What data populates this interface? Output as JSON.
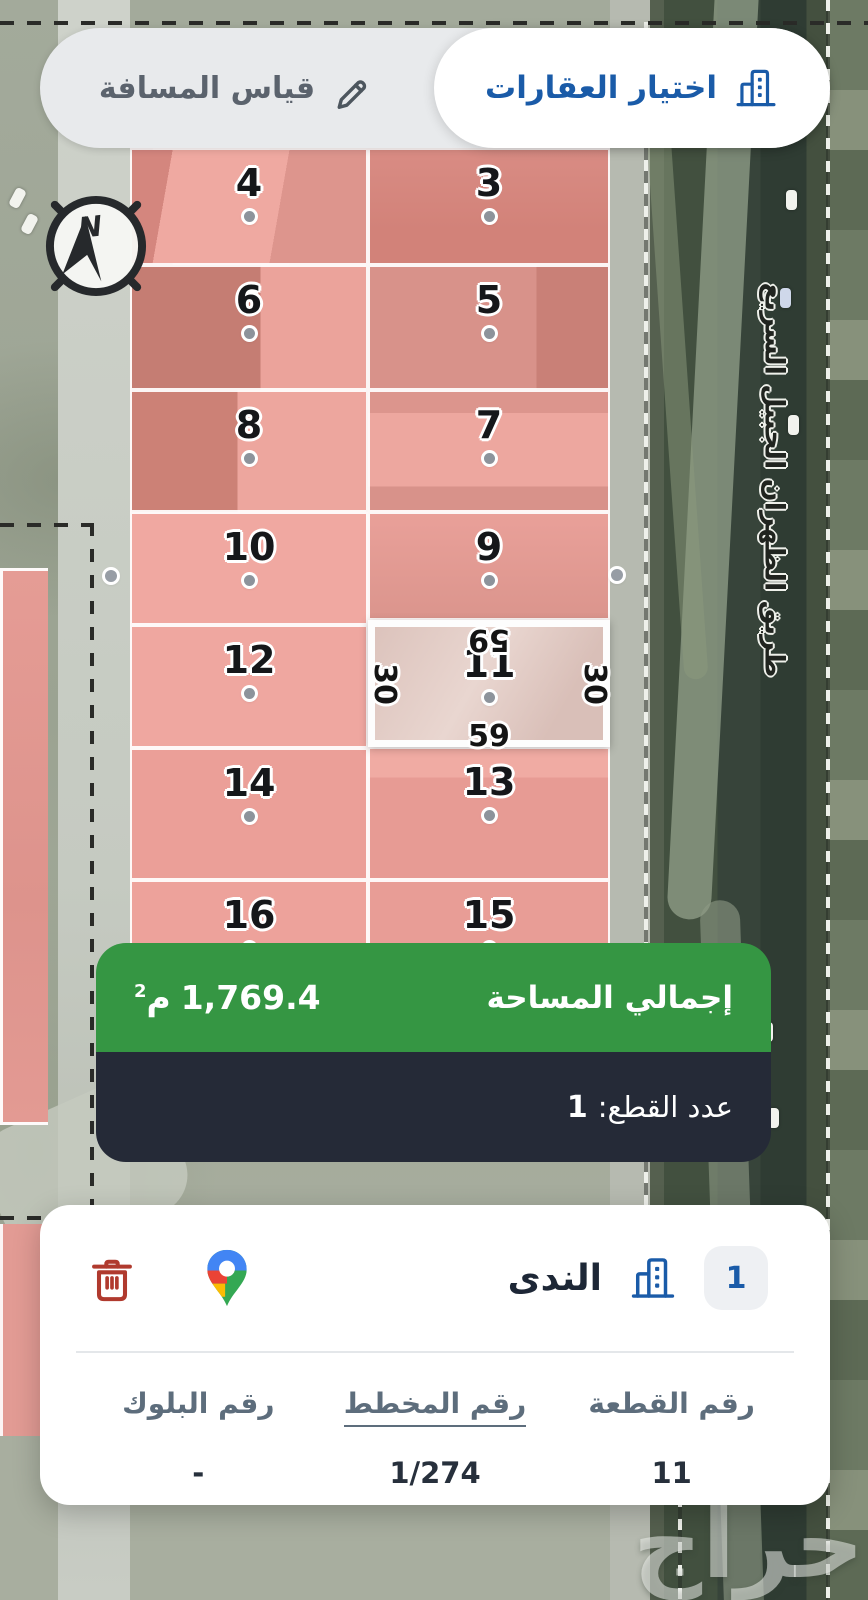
{
  "toolbar": {
    "select_tab": "اختيار العقارات",
    "measure_tab": "قياس المسافة"
  },
  "map": {
    "compass_label": "N",
    "road_label": "طريق الظهران الجبيل السريع",
    "watermark": "حراج",
    "parcels": [
      {
        "number": "4"
      },
      {
        "number": "3"
      },
      {
        "number": "6"
      },
      {
        "number": "5"
      },
      {
        "number": "8"
      },
      {
        "number": "7"
      },
      {
        "number": "10"
      },
      {
        "number": "9"
      },
      {
        "number": "12"
      },
      {
        "number": "14"
      },
      {
        "number": "13"
      },
      {
        "number": "16"
      },
      {
        "number": "15"
      }
    ],
    "selected_parcel": {
      "number": "11",
      "dim_top": "59",
      "dim_bottom": "59",
      "dim_left": "30",
      "dim_right": "30"
    }
  },
  "summary": {
    "area_label": "إجمالي المساحة",
    "area_value": "1,769.4",
    "area_unit": "م",
    "area_unit_sup": "2",
    "count_label": "عدد القطع:",
    "count_value": "1"
  },
  "card": {
    "badge": "1",
    "name": "الندى",
    "columns": [
      {
        "header": "رقم القطعة",
        "value": "11"
      },
      {
        "header": "رقم المخطط",
        "value": "1/274"
      },
      {
        "header": "رقم البلوك",
        "value": "-"
      }
    ]
  },
  "colors": {
    "accent_blue": "#1a5ba8",
    "total_green": "#359643",
    "count_dark": "#252a37",
    "trash_red": "#b03a2e",
    "parcel_pink": "#eda29b"
  }
}
